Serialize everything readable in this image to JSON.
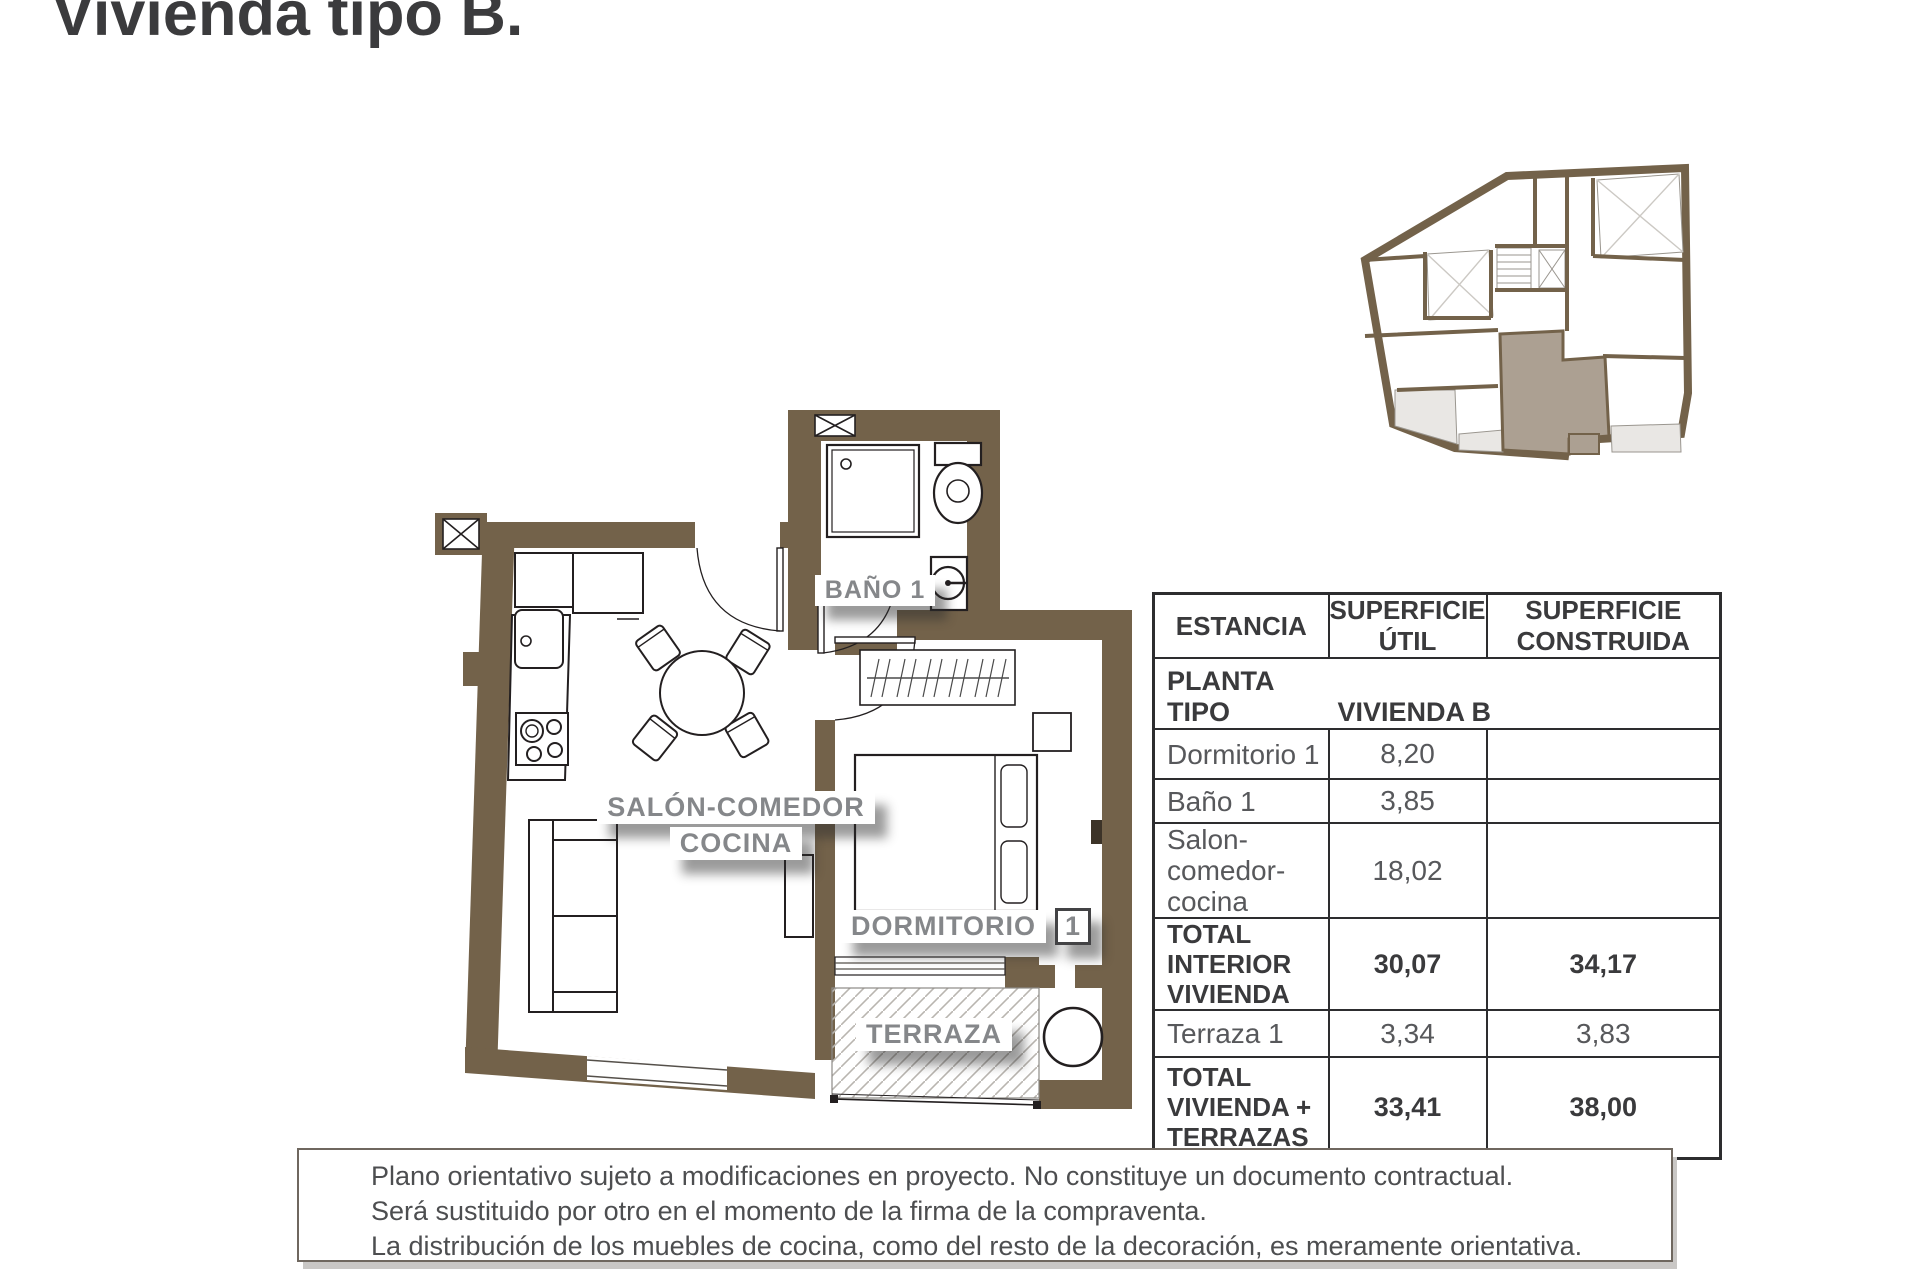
{
  "title": "Vivienda tipo B.",
  "plan_labels": {
    "bano": "BAÑO 1",
    "salon_line1": "SALÓN-COMEDOR",
    "salon_line2": "COCINA",
    "dormitorio": "DORMITORIO",
    "dormitorio_num": "1",
    "terraza": "TERRAZA"
  },
  "table": {
    "headers": [
      "ESTANCIA",
      "SUPERFICIE ÚTIL",
      "SUPERFICIE CONSTRUIDA"
    ],
    "subheader": {
      "left": "PLANTA TIPO",
      "right": "VIVIENDA B"
    },
    "rows": [
      {
        "name": "Dormitorio 1",
        "util": "8,20",
        "construida": ""
      },
      {
        "name": "Baño 1",
        "util": "3,85",
        "construida": ""
      },
      {
        "name": "Salon-comedor-cocina",
        "util": "18,02",
        "construida": ""
      },
      {
        "name": "TOTAL INTERIOR VIVIENDA",
        "util": "30,07",
        "construida": "34,17"
      },
      {
        "name": "Terraza 1",
        "util": "3,34",
        "construida": "3,83"
      },
      {
        "name": "TOTAL VIVIENDA + TERRAZAS",
        "util": "33,41",
        "construida": "38,00"
      }
    ]
  },
  "disclaimer": {
    "line1": "Plano orientativo sujeto a modificaciones en proyecto. No constituye un documento contractual.",
    "line2": "Será sustituido por otro en el momento de la firma de la compraventa.",
    "line3": "La distribución de los muebles de cocina, como del resto de la decoración, es meramente orientativa."
  },
  "colors": {
    "wall_brown": "#73624a",
    "highlight_unit": "#aca092",
    "patio_light": "#e9e7e4",
    "label_gray": "#85878a",
    "text_dark": "#3a3a3c",
    "text_data": "#57585b",
    "hatch_gray": "#b9b5b0"
  }
}
